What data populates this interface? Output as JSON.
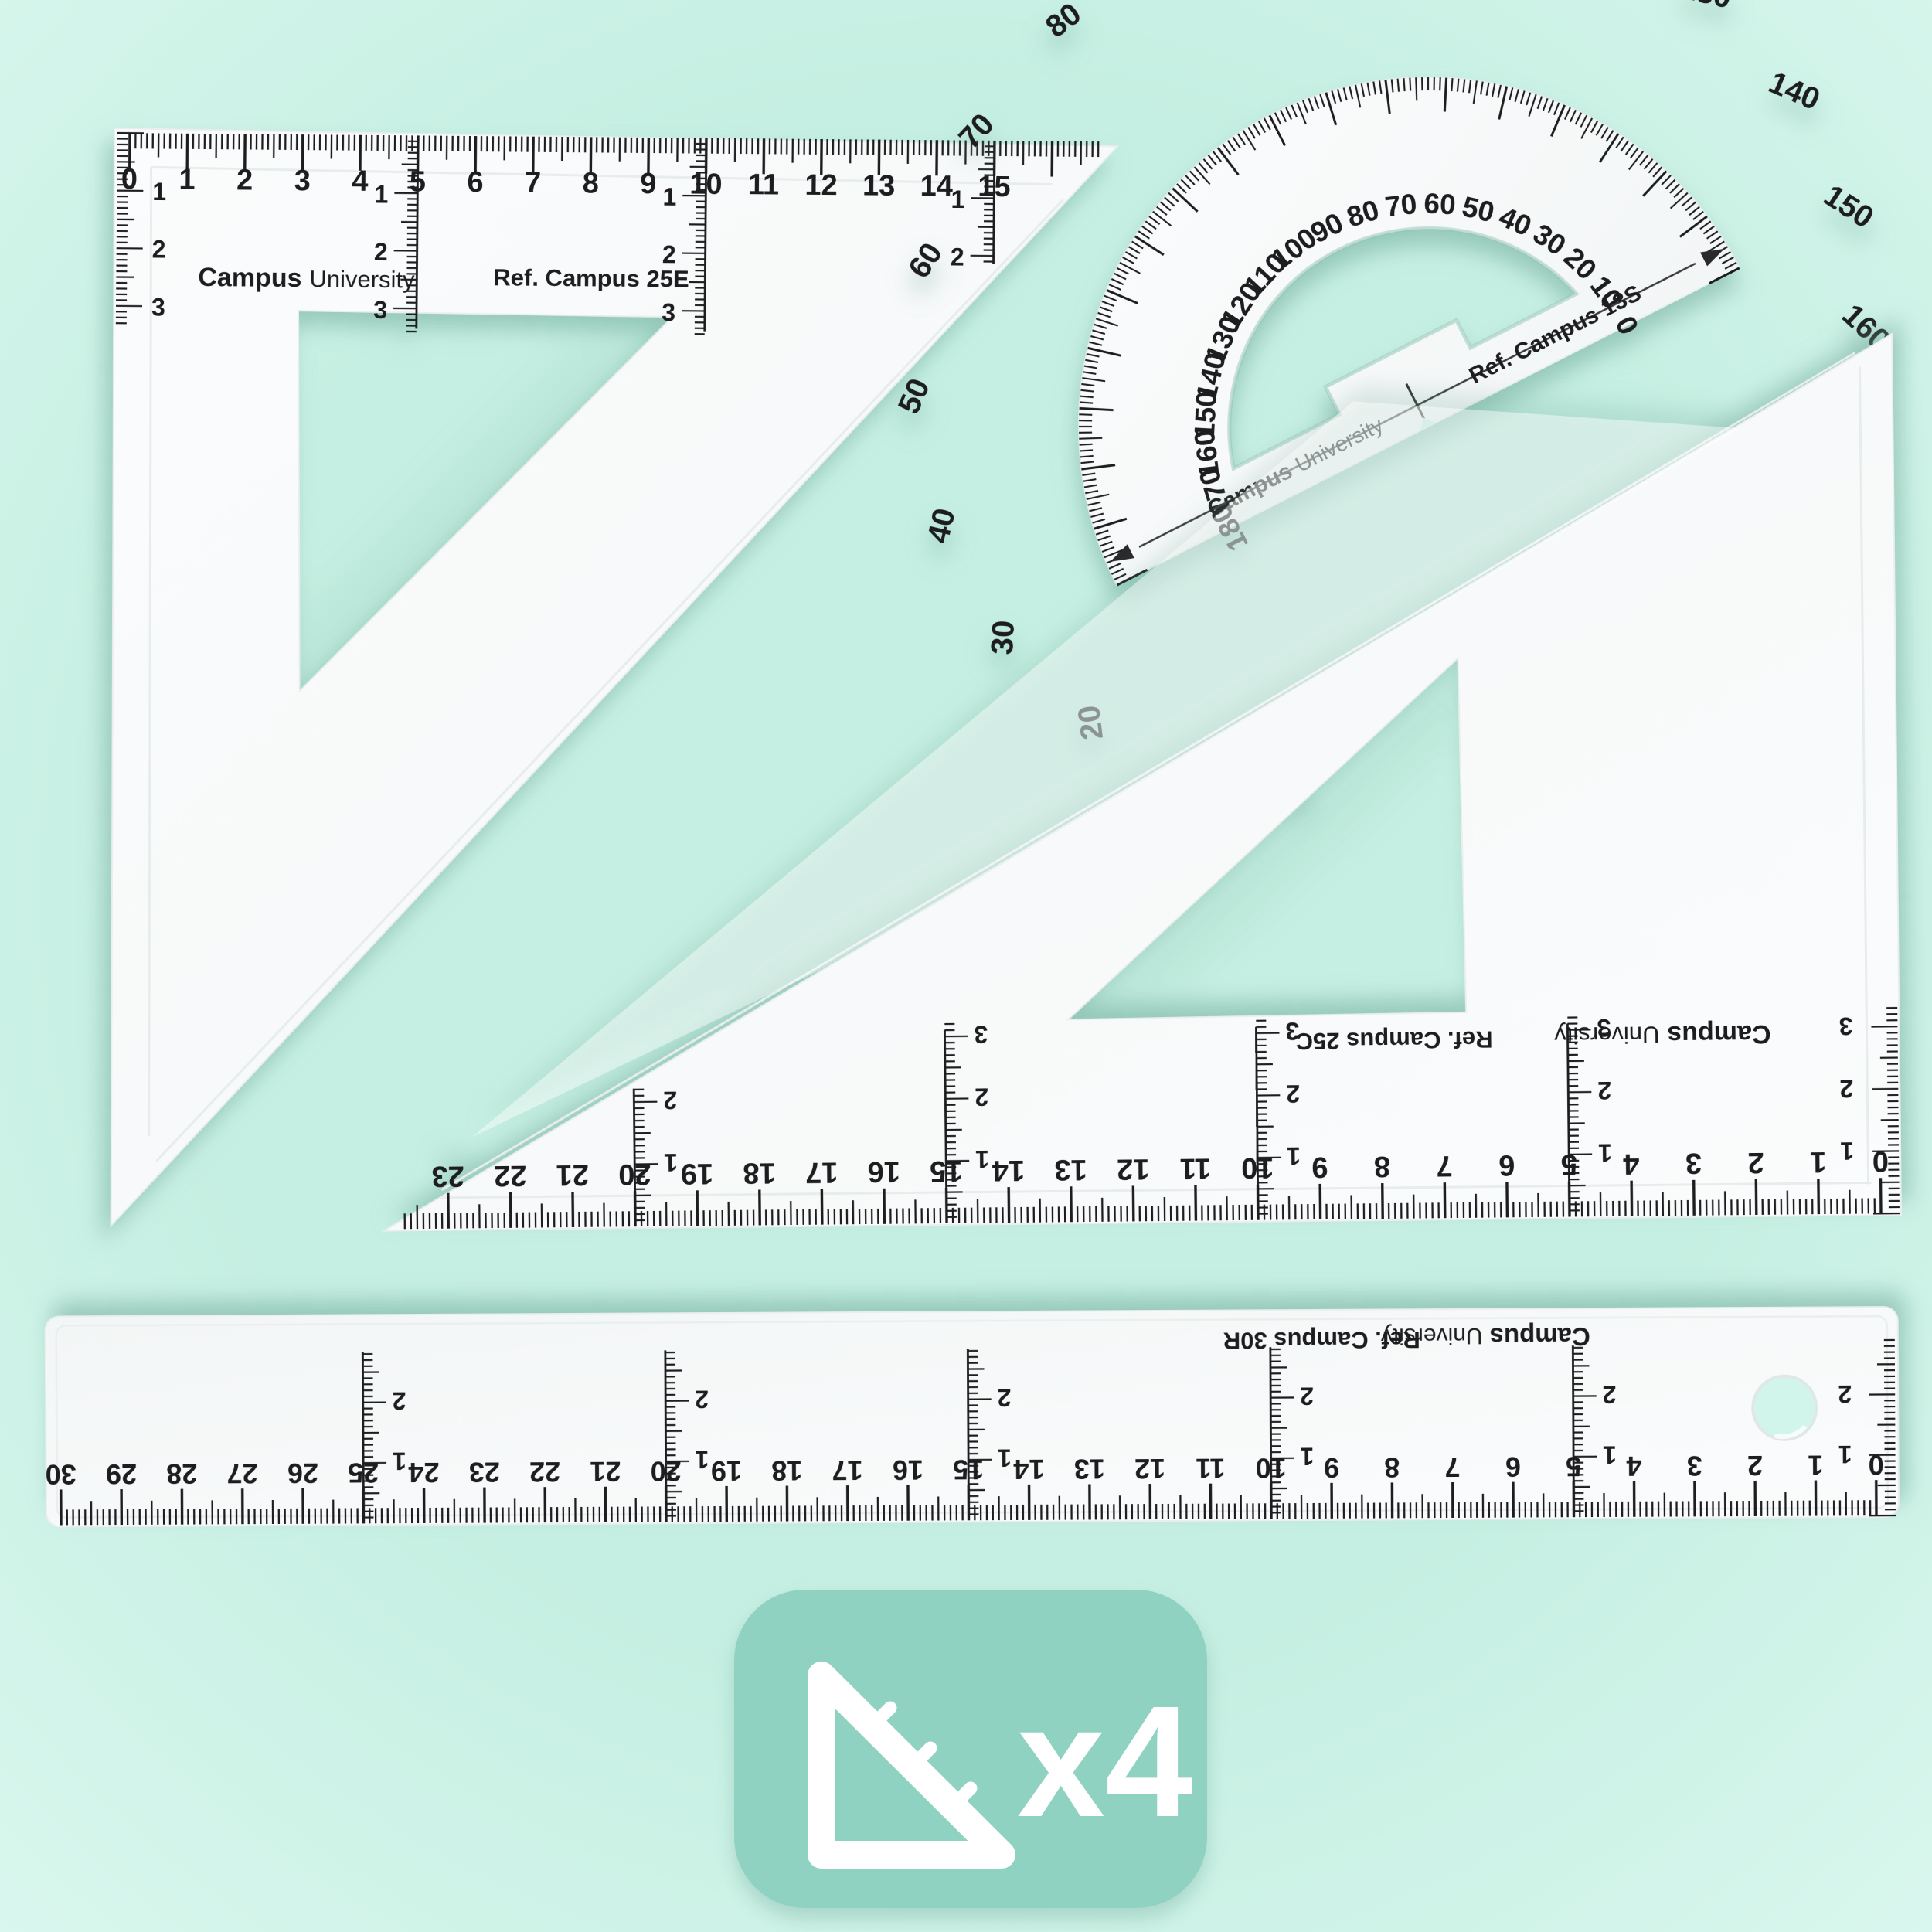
{
  "background": {
    "color_center": "#c5efe2",
    "color_edge": "#daf7ee"
  },
  "ink_color": "#1d1d1f",
  "plastic": {
    "fill_light": "#fbfcfd",
    "fill_dark": "#f3f6f6",
    "bevel": "#e7ecec",
    "shadow": "rgba(104,163,146,0.5)"
  },
  "brand": {
    "bold": "Campus",
    "light": "University"
  },
  "set_square_45": {
    "ref_label": "Ref. Campus 25E",
    "scale": {
      "unit": "cm",
      "from": 0,
      "to": 15
    },
    "side_scale_labels": [
      1,
      2,
      3
    ]
  },
  "protractor": {
    "ref_label": "Ref. Campus 13S",
    "outer_scale": {
      "from": 0,
      "to": 180,
      "step": 10
    },
    "inner_scale": {
      "from": 180,
      "to": 0,
      "step": 10
    },
    "accent_outer_values": [
      0,
      10
    ],
    "accent_color": "#a39b55"
  },
  "set_square_30_60": {
    "ref_label": "Ref. Campus 25C",
    "scale": {
      "unit": "cm",
      "from": 0,
      "to": 23
    },
    "side_scale_labels": [
      1,
      2,
      3
    ]
  },
  "ruler": {
    "ref_label": "Ref. Campus 30R",
    "scale": {
      "unit": "cm",
      "from": 0,
      "to": 30
    },
    "side_scale_labels": [
      1,
      2
    ]
  },
  "badge": {
    "label": "x4",
    "color": "#8fd2c1",
    "icon": "set-square-icon"
  }
}
